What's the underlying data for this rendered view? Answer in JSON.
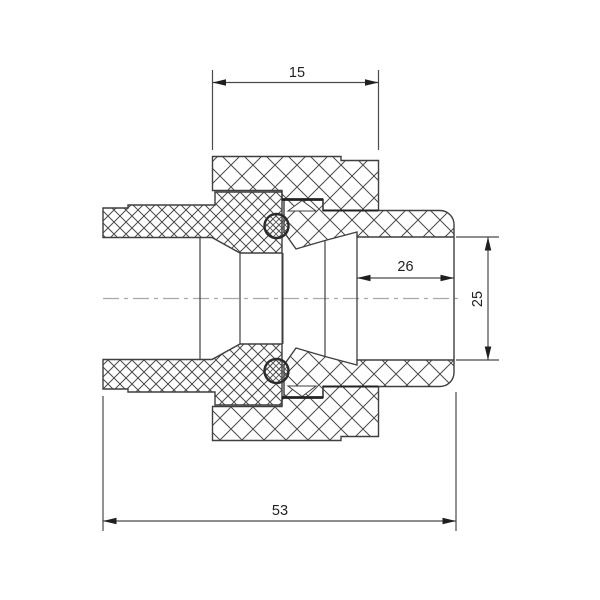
{
  "drawing": {
    "type": "cross-section technical drawing of a pipe union coupling",
    "dimension_labels": {
      "nut_width": "15",
      "socket_depth": "26",
      "socket_diameter": "25",
      "overall_length": "53"
    },
    "colors": {
      "background": "#ffffff",
      "outline": "#3f3f3f",
      "hatch": "#4a4a4a",
      "thread_line": "#222222",
      "centerline": "#a8a8a8",
      "dimension_line": "#4a4a4a",
      "dimension_text": "#1f1f1f"
    }
  }
}
